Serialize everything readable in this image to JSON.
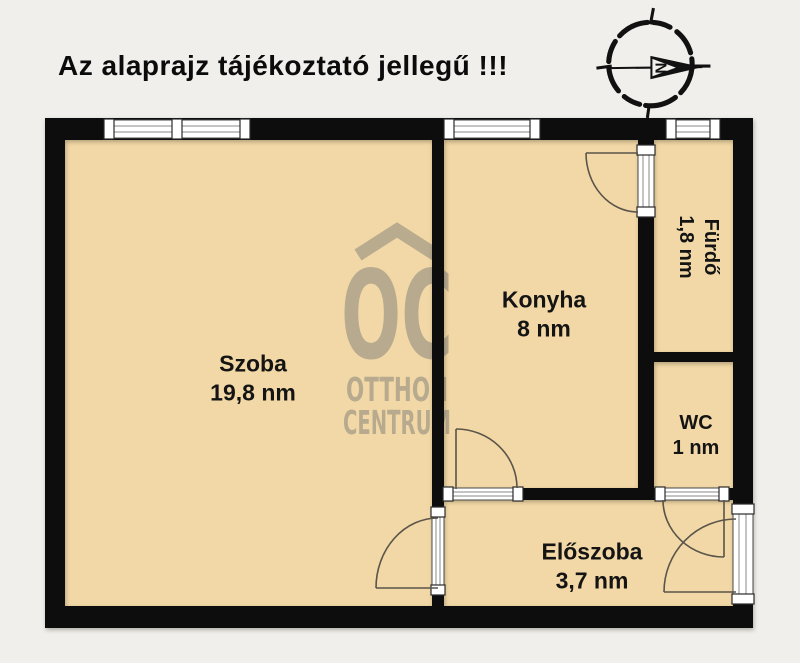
{
  "title": "Az alaprajz tájékoztató jellegű !!!",
  "compass": {
    "north_label": "N"
  },
  "watermark": {
    "monogram": "OC",
    "line1": "OTTHON",
    "line2": "CENTRUM"
  },
  "rooms": {
    "szoba": {
      "name": "Szoba",
      "area": "19,8 nm"
    },
    "konyha": {
      "name": "Konyha",
      "area": "8 nm"
    },
    "furdo": {
      "name": "Fürdő",
      "area": "1,8 nm"
    },
    "wc": {
      "name": "WC",
      "area": "1 nm"
    },
    "eloszoba": {
      "name": "Előszoba",
      "area": "3,7 nm"
    }
  },
  "colors": {
    "background": "#f0efeb",
    "floor": "#f2d8a6",
    "wall": "#0d0d0d",
    "watermark": "#a89e88"
  }
}
